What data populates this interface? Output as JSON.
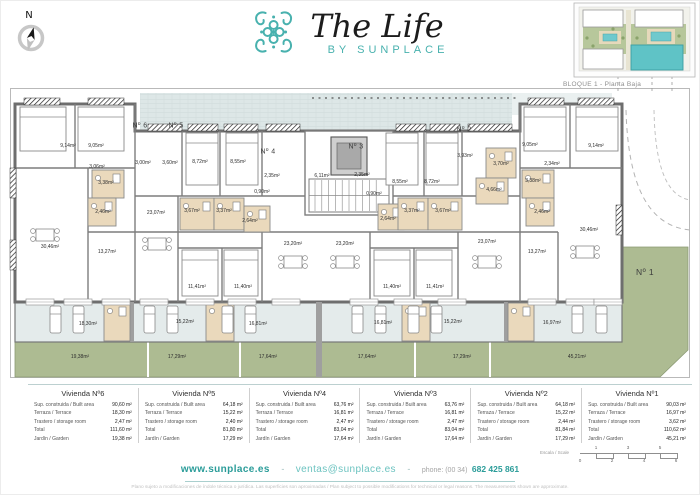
{
  "brand": {
    "logo_title": "The Life",
    "logo_subtitle": "BY SUNPLACE",
    "compass_label": "N",
    "site_plan_caption": "BLOQUE 1 - Planta Baja",
    "teal": "#48b1ae",
    "garden_green": "#adbb92",
    "terrace_grey": "#e4ebeb"
  },
  "plan": {
    "unit_markers": [
      {
        "label": "Nº 6",
        "x": 140,
        "y": 126
      },
      {
        "label": "Nº 5",
        "x": 176,
        "y": 126
      },
      {
        "label": "Nº 4",
        "x": 268,
        "y": 152
      },
      {
        "label": "Nº 3",
        "x": 356,
        "y": 147
      },
      {
        "label": "Nº 2",
        "x": 464,
        "y": 130
      },
      {
        "label": "Nº 1",
        "x": 645,
        "y": 272
      }
    ],
    "room_labels": [
      {
        "text": "9,14m²",
        "x": 68,
        "y": 146
      },
      {
        "text": "9,05m²",
        "x": 96,
        "y": 146
      },
      {
        "text": "3,06m²",
        "x": 97,
        "y": 167
      },
      {
        "text": "3,38m²",
        "x": 106,
        "y": 183
      },
      {
        "text": "2,46m²",
        "x": 103,
        "y": 212
      },
      {
        "text": "30,46m²",
        "x": 50,
        "y": 247
      },
      {
        "text": "13,27m²",
        "x": 107,
        "y": 252
      },
      {
        "text": "3,00m²",
        "x": 143,
        "y": 163
      },
      {
        "text": "3,60m²",
        "x": 170,
        "y": 163
      },
      {
        "text": "23,07m²",
        "x": 156,
        "y": 213
      },
      {
        "text": "11,41m²",
        "x": 197,
        "y": 287
      },
      {
        "text": "8,72m²",
        "x": 200,
        "y": 162
      },
      {
        "text": "8,55m²",
        "x": 238,
        "y": 162
      },
      {
        "text": "2,35m²",
        "x": 272,
        "y": 176
      },
      {
        "text": "0,90m²",
        "x": 262,
        "y": 192
      },
      {
        "text": "3,67m²",
        "x": 192,
        "y": 211
      },
      {
        "text": "3,37m²",
        "x": 224,
        "y": 211
      },
      {
        "text": "2,64m²",
        "x": 250,
        "y": 221
      },
      {
        "text": "23,20m²",
        "x": 293,
        "y": 244
      },
      {
        "text": "11,40m²",
        "x": 243,
        "y": 287
      },
      {
        "text": "6,11m²",
        "x": 322,
        "y": 176
      },
      {
        "text": "23,20m²",
        "x": 345,
        "y": 244
      },
      {
        "text": "2,35m²",
        "x": 362,
        "y": 175
      },
      {
        "text": "0,90m²",
        "x": 374,
        "y": 194
      },
      {
        "text": "8,55m²",
        "x": 400,
        "y": 182
      },
      {
        "text": "8,72m²",
        "x": 432,
        "y": 182
      },
      {
        "text": "2,64m²",
        "x": 388,
        "y": 219
      },
      {
        "text": "3,37m²",
        "x": 412,
        "y": 211
      },
      {
        "text": "3,67m²",
        "x": 443,
        "y": 211
      },
      {
        "text": "11,40m²",
        "x": 392,
        "y": 287
      },
      {
        "text": "11,41m²",
        "x": 435,
        "y": 287
      },
      {
        "text": "3,93m²",
        "x": 465,
        "y": 156
      },
      {
        "text": "3,70m²",
        "x": 501,
        "y": 164
      },
      {
        "text": "4,66m²",
        "x": 494,
        "y": 190
      },
      {
        "text": "23,07m²",
        "x": 487,
        "y": 242
      },
      {
        "text": "9,05m²",
        "x": 530,
        "y": 145
      },
      {
        "text": "9,14m²",
        "x": 596,
        "y": 146
      },
      {
        "text": "2,34m²",
        "x": 552,
        "y": 164
      },
      {
        "text": "3,38m²",
        "x": 533,
        "y": 181
      },
      {
        "text": "2,46m²",
        "x": 542,
        "y": 212
      },
      {
        "text": "30,46m²",
        "x": 589,
        "y": 230
      },
      {
        "text": "13,27m²",
        "x": 537,
        "y": 252
      },
      {
        "text": "18,30m²",
        "x": 88,
        "y": 324
      },
      {
        "text": "15,22m²",
        "x": 185,
        "y": 322
      },
      {
        "text": "16,81m²",
        "x": 258,
        "y": 324
      },
      {
        "text": "16,81m²",
        "x": 383,
        "y": 323
      },
      {
        "text": "15,22m²",
        "x": 453,
        "y": 322
      },
      {
        "text": "16,97m²",
        "x": 552,
        "y": 323
      },
      {
        "text": "19,38m²",
        "x": 80,
        "y": 357
      },
      {
        "text": "17,29m²",
        "x": 177,
        "y": 357
      },
      {
        "text": "17,64m²",
        "x": 268,
        "y": 357
      },
      {
        "text": "17,64m²",
        "x": 367,
        "y": 357
      },
      {
        "text": "17,29m²",
        "x": 462,
        "y": 357
      },
      {
        "text": "45,21m²",
        "x": 577,
        "y": 357
      }
    ]
  },
  "tables": {
    "row_labels": [
      "Sup. construida / Built area",
      "Terraza / Terrace",
      "Trastero / storage room",
      "Total",
      "Jardín / Garden"
    ],
    "units": [
      {
        "name": "Vivienda Nº6",
        "values": [
          "90,60 m²",
          "18,30 m²",
          "2,47 m²",
          "111,60 m²",
          "19,38 m²"
        ]
      },
      {
        "name": "Vivienda Nº5",
        "values": [
          "64,18 m²",
          "15,22 m²",
          "2,40 m²",
          "81,80 m²",
          "17,29 m²"
        ]
      },
      {
        "name": "Vivienda Nº4",
        "values": [
          "63,76 m²",
          "16,81 m²",
          "2,47 m²",
          "83,04 m²",
          "17,64 m²"
        ]
      },
      {
        "name": "Vivienda Nº3",
        "values": [
          "63,76 m²",
          "16,81 m²",
          "2,47 m²",
          "83,04 m²",
          "17,64 m²"
        ]
      },
      {
        "name": "Vivienda Nº2",
        "values": [
          "64,18 m²",
          "15,22 m²",
          "2,44 m²",
          "81,84 m²",
          "17,29 m²"
        ]
      },
      {
        "name": "Vivienda Nº1",
        "values": [
          "90,03 m²",
          "16,97 m²",
          "3,62 m²",
          "110,62 m²",
          "45,21 m²"
        ]
      }
    ]
  },
  "scale": {
    "label": "Escala / Scale",
    "top_numbers": [
      "1",
      "3",
      "5"
    ],
    "bottom_numbers": [
      "0",
      "2",
      "4",
      "6"
    ]
  },
  "footer": {
    "website": "www.sunplace.es",
    "separator": "-",
    "email": "ventas@sunplace.es",
    "phone_label": "phone: (00 34)",
    "phone_number": "682 425 861",
    "disclaimer": "Plano sujeto a modificaciones de índole técnica o jurídica. Las superficies son aproximadas / Plan subject to possible modifications for technical or legal reasons. The measurements shown are approximate."
  }
}
